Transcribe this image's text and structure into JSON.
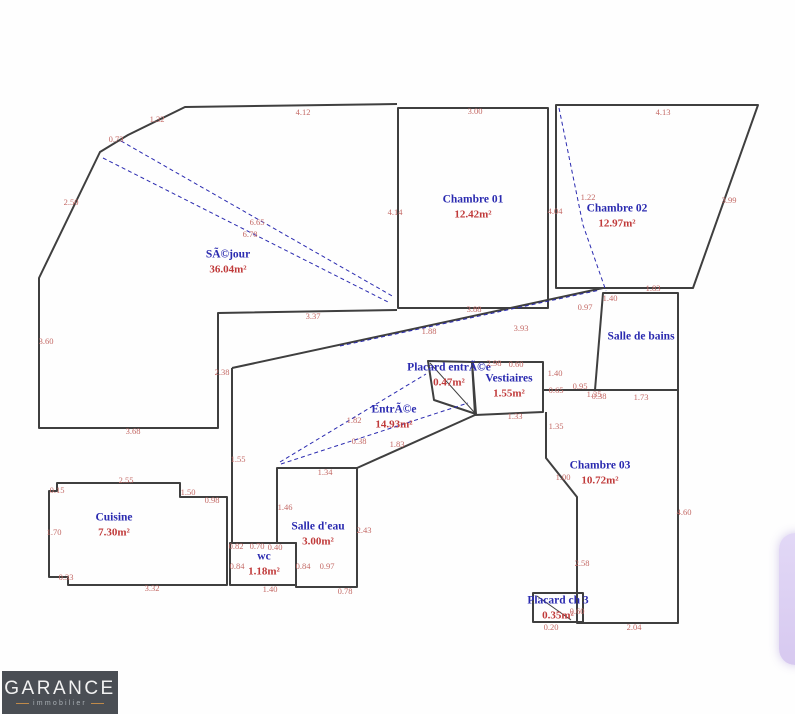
{
  "plan": {
    "rooms": {
      "sejour": {
        "name": "SÃ©jour",
        "area": "36.04m²"
      },
      "chambre01": {
        "name": "Chambre 01",
        "area": "12.42m²"
      },
      "chambre02": {
        "name": "Chambre 02",
        "area": "12.97m²"
      },
      "salle_de_bains": {
        "name": "Salle de bains",
        "area": ""
      },
      "placard_entree": {
        "name": "Placard entrÃ©e",
        "area": "0.47m²"
      },
      "vestiaires": {
        "name": "Vestiaires",
        "area": "1.55m²"
      },
      "entree": {
        "name": "EntrÃ©e",
        "area": "14.93m²"
      },
      "chambre03": {
        "name": "Chambre 03",
        "area": "10.72m²"
      },
      "cuisine": {
        "name": "Cuisine",
        "area": "7.30m²"
      },
      "salle_deau": {
        "name": "Salle d'eau",
        "area": "3.00m²"
      },
      "wc": {
        "name": "wc",
        "area": "1.18m²"
      },
      "placard_ch3": {
        "name": "Placard ch 3",
        "area": "0.35m²"
      }
    },
    "dims": [
      "4.12",
      "1.32",
      "0.73",
      "2.50",
      "3.60",
      "3.68",
      "6.65",
      "6.78",
      "3.37",
      "2.38",
      "3.00",
      "4.14",
      "4.04",
      "3.88",
      "1.88",
      "3.93",
      "4.13",
      "1.22",
      "3.99",
      "1.83",
      "1.40",
      "0.97",
      "0.95",
      "0.38",
      "1.73",
      "2.98",
      "0.60",
      "1.40",
      "0.65",
      "1.35",
      "1.33",
      "1.35",
      "1.82",
      "0.38",
      "1.83",
      "1.00",
      "2.58",
      "4.60",
      "2.04",
      "0.60",
      "0.20",
      "2.55",
      "0.15",
      "1.50",
      "0.98",
      "1.70",
      "0.33",
      "3.32",
      "1.55",
      "1.34",
      "1.46",
      "2.43",
      "0.82",
      "0.70",
      "0.40",
      "0.84",
      "0.84",
      "0.97",
      "1.40",
      "0.78"
    ],
    "colors": {
      "wall": "#3f3f3f",
      "room_label": "#2b2bb0",
      "measure": "#c46a66",
      "area_label": "#c03a3a",
      "widget": "#d9cdf2"
    }
  },
  "logo": {
    "brand": "GARANCE",
    "tagline": "immobilier",
    "bg": "#4a4e54",
    "accent": "#c08a4a"
  }
}
